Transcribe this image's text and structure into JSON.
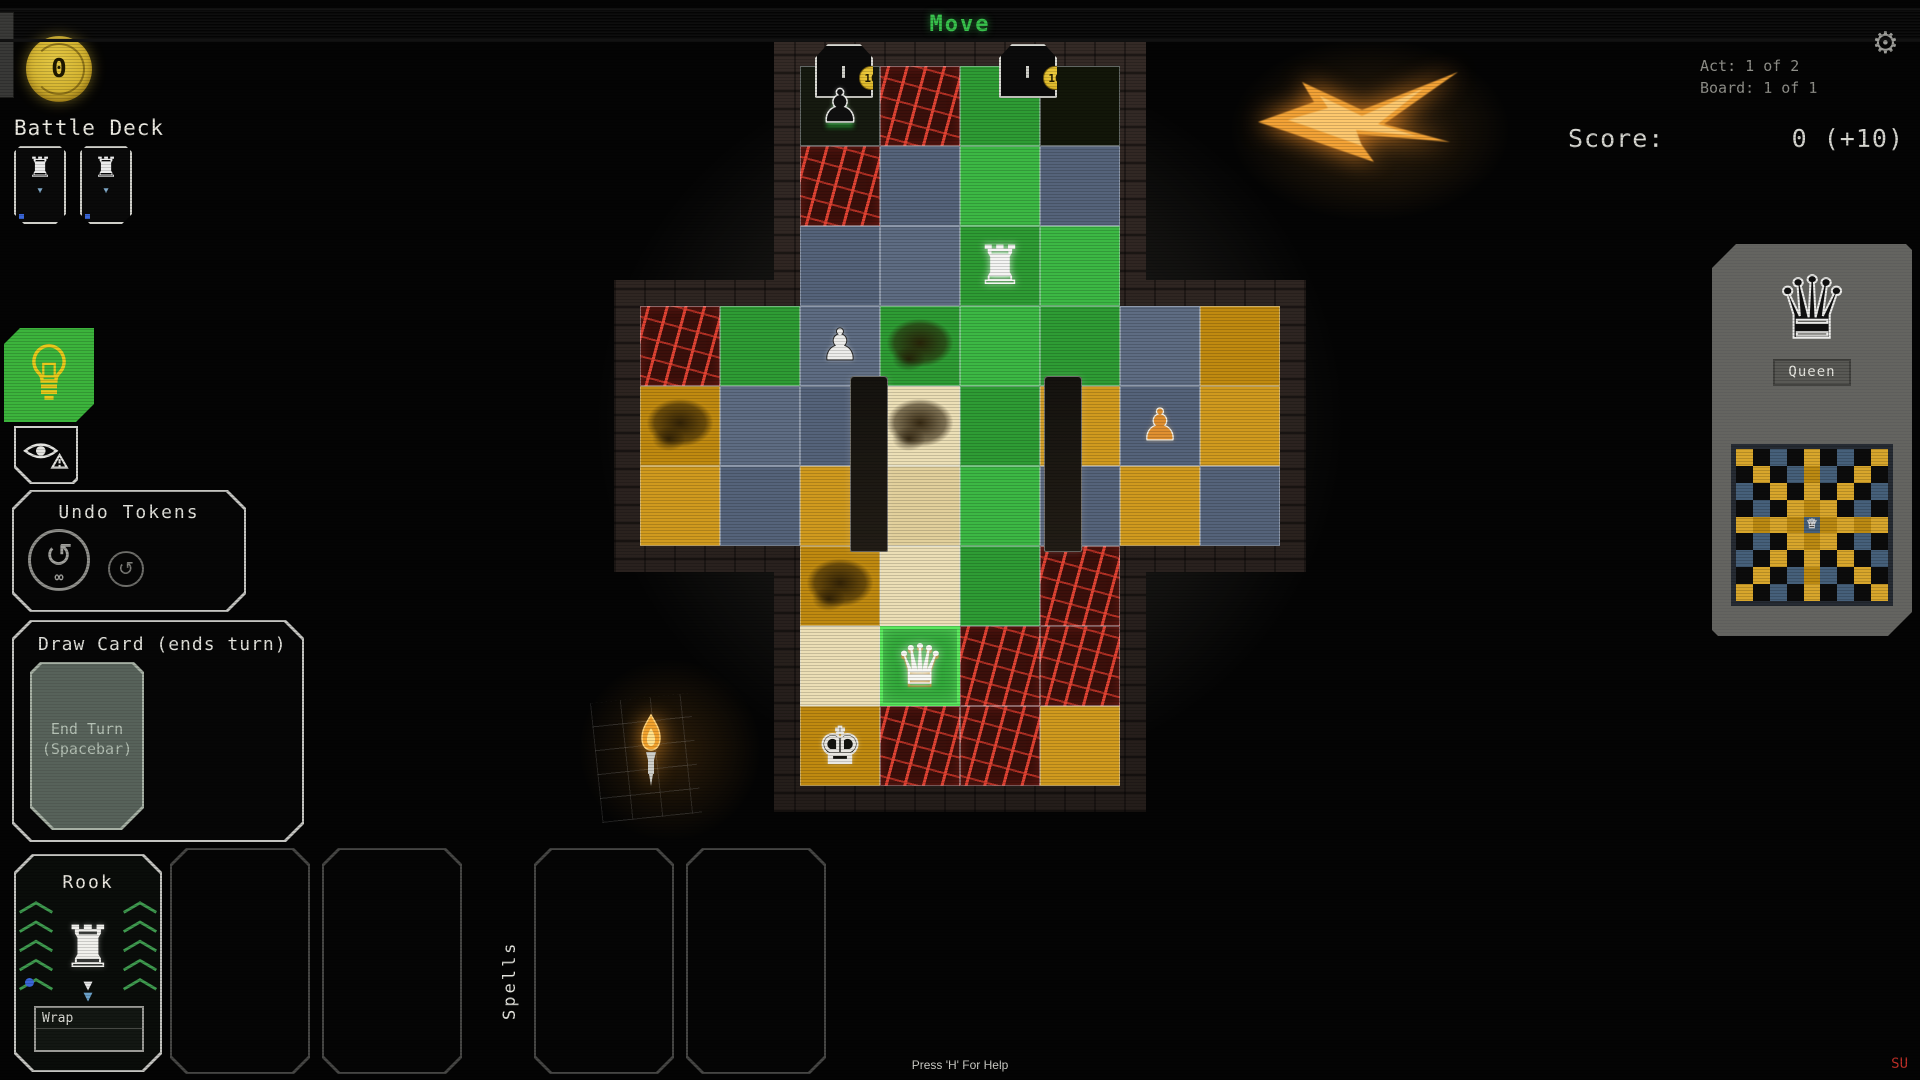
{
  "title_bar": {
    "title": "Move"
  },
  "top_right": {
    "act": "Act: 1 of 2",
    "board": "Board: 1 of 1",
    "score_label": "Score:",
    "score_value": "0 (+10)"
  },
  "resources": {
    "coins": "0"
  },
  "deck": {
    "label": "Battle Deck",
    "cards": [
      {
        "piece": "rook"
      },
      {
        "piece": "rook"
      }
    ]
  },
  "undo_panel": {
    "title": "Undo Tokens",
    "tokens": [
      {
        "type": "infinite-undo"
      },
      {
        "type": "single-undo"
      }
    ]
  },
  "draw_panel": {
    "title": "Draw Card (ends turn)",
    "end_turn_card": {
      "line1": "End Turn",
      "line2": "(Spacebar)"
    }
  },
  "hand": {
    "cards": [
      {
        "title": "Rook",
        "keyword": "Wrap"
      }
    ],
    "spells_label": "Spells"
  },
  "board": {
    "tile_legend": {
      "S": "slate",
      "G": "green",
      "H": "green-highlight",
      "O": "gold",
      "T": "tan",
      "R": "lava",
      "D": "dark",
      ".": "none"
    },
    "tiles": [
      "..DRGD..",
      "..RSGS..",
      "..SSGG..",
      "RGSGGGSO",
      "OSSTGOSO",
      "OSOTGSOS",
      "..OTGR..",
      "..THRR..",
      "..ORRO.."
    ],
    "pieces": [
      {
        "type": "enemy-pawn",
        "r": 0,
        "c": 2,
        "player": false
      },
      {
        "type": "rook",
        "r": 2,
        "c": 4,
        "player": true
      },
      {
        "type": "enemy-maid",
        "r": 3,
        "c": 2,
        "player": false
      },
      {
        "type": "enemy-archer",
        "r": 4,
        "c": 6,
        "player": false
      },
      {
        "type": "queen",
        "r": 7,
        "c": 3,
        "player": true
      },
      {
        "type": "king",
        "r": 8,
        "c": 2,
        "player": false
      }
    ],
    "doors": [
      {
        "c": 2.55,
        "coin": "10"
      },
      {
        "c": 4.85,
        "coin": "10"
      }
    ],
    "pillars": [
      {
        "c": 2.62
      },
      {
        "c": 5.05
      }
    ],
    "mud": [
      {
        "r": 3,
        "c": 3
      },
      {
        "r": 4,
        "c": 3
      },
      {
        "r": 4,
        "c": 0
      },
      {
        "r": 6,
        "c": 2
      }
    ]
  },
  "inspector": {
    "piece_label": "Queen",
    "mini_board": {
      "size": 9,
      "piece": "queen"
    }
  },
  "footer": {
    "help": "Press 'H' For Help",
    "corner_tag": "SU"
  },
  "colors": {
    "accent_green": "#38c14c",
    "coin_gold": "#d8b92e",
    "hint_bg": "#3cb43c",
    "tile_green": "#35b33b",
    "tile_gold": "#c8921a",
    "tile_slate": "#5a6878",
    "tile_tan": "#e6d6a4",
    "lava_red": "#d83830"
  }
}
